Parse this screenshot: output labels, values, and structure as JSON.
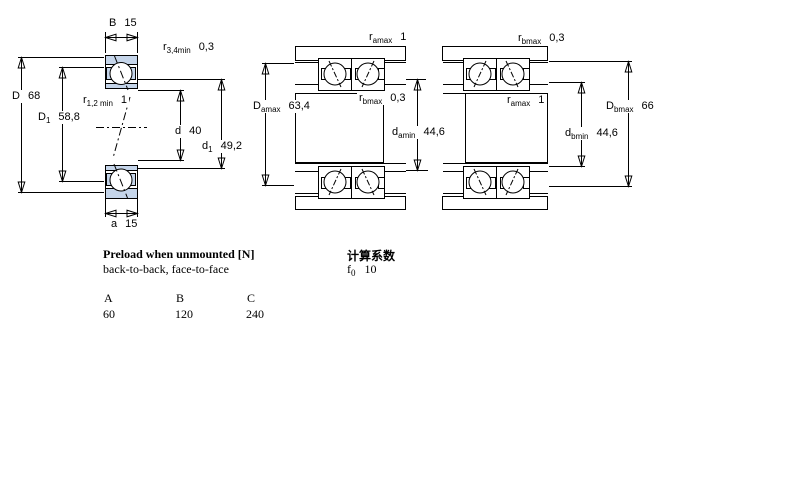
{
  "drawing": {
    "left": {
      "B": {
        "sym": "B",
        "val": "15"
      },
      "r34": {
        "sym": "r",
        "sub": "3,4min",
        "val": "0,3"
      },
      "D": {
        "sym": "D",
        "val": "68"
      },
      "D1": {
        "sym": "D",
        "sub": "1",
        "val": "58,8"
      },
      "r12": {
        "sym": "r",
        "sub": "1,2 min",
        "val": "1"
      },
      "d": {
        "sym": "d",
        "val": "40"
      },
      "d1": {
        "sym": "d",
        "sub": "1",
        "val": "49,2"
      },
      "a": {
        "sym": "a",
        "val": "15"
      }
    },
    "middle": {
      "ramax": {
        "sym": "r",
        "sub": "amax",
        "val": "1"
      },
      "Damax": {
        "sym": "D",
        "sub": "amax",
        "val": "63,4"
      },
      "rbmax": {
        "sym": "r",
        "sub": "bmax",
        "val": "0,3"
      },
      "damin": {
        "sym": "d",
        "sub": "amin",
        "val": "44,6"
      }
    },
    "right": {
      "rbmax": {
        "sym": "r",
        "sub": "bmax",
        "val": "0,3"
      },
      "ramax": {
        "sym": "r",
        "sub": "amax",
        "val": "1"
      },
      "Dbmax": {
        "sym": "D",
        "sub": "bmax",
        "val": "66"
      },
      "dbmin": {
        "sym": "d",
        "sub": "bmin",
        "val": "44,6"
      }
    }
  },
  "preload": {
    "title": "Preload when unmounted [N]",
    "subtitle": "back-to-back, face-to-face",
    "columns": [
      "A",
      "B",
      "C"
    ],
    "values": [
      "60",
      "120",
      "240"
    ]
  },
  "calculation": {
    "title": "计算系数",
    "factor": {
      "sym": "f",
      "sub": "0",
      "val": "10"
    }
  },
  "colors": {
    "line": "#000000",
    "bearing_ring_fill": "#c5d5ea",
    "steel_dark": "#c2baba",
    "steel_light": "#f2f6ee",
    "background": "#ffffff"
  }
}
